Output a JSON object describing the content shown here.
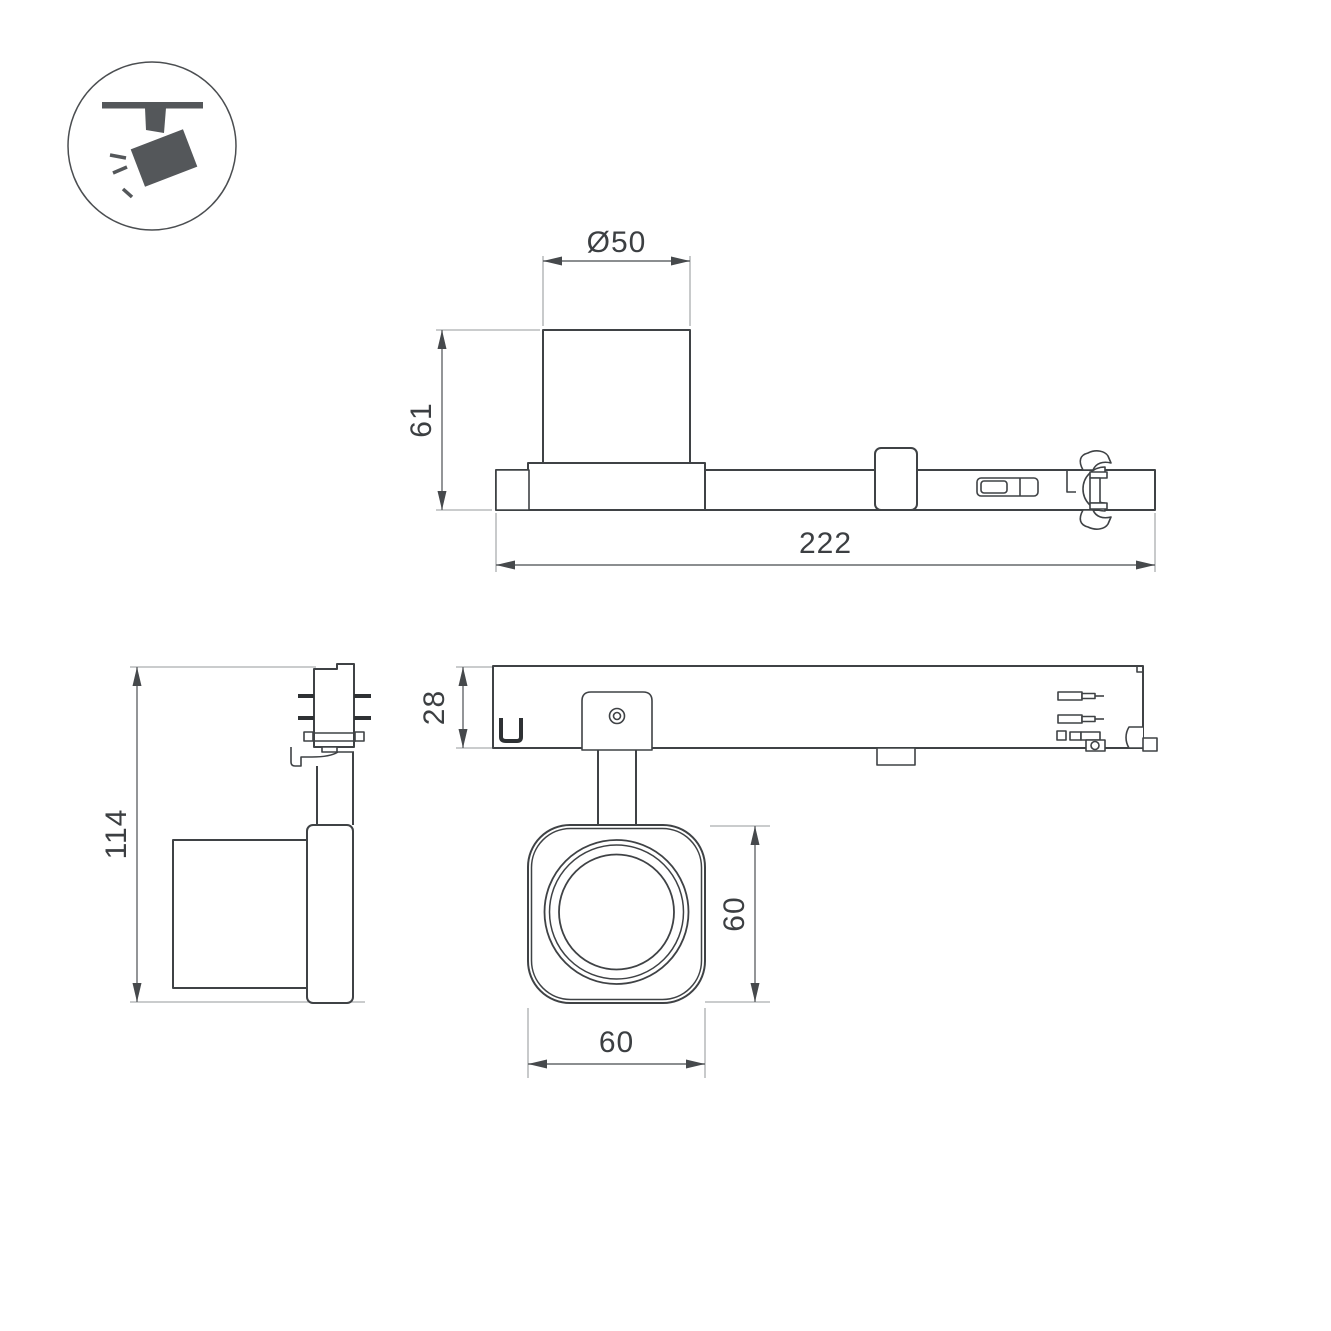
{
  "icon": {
    "name": "ceiling-track-spotlight-icon"
  },
  "views": {
    "side": {
      "label": "side-view",
      "dims": {
        "diameter": "Ø50",
        "height": "61",
        "length": "222"
      }
    },
    "end": {
      "label": "end-view",
      "dims": {
        "height": "114"
      }
    },
    "bottom": {
      "label": "bottom-view",
      "dims": {
        "track": "28",
        "head_h": "60",
        "head_w": "60"
      }
    }
  },
  "colors": {
    "background": "#ffffff",
    "outline": "#3f4245",
    "dimension_line": "#65686b",
    "extension_line": "#abadaf",
    "arrow": "#46494c",
    "text": "#3c3f42",
    "icon": "#54575a"
  }
}
